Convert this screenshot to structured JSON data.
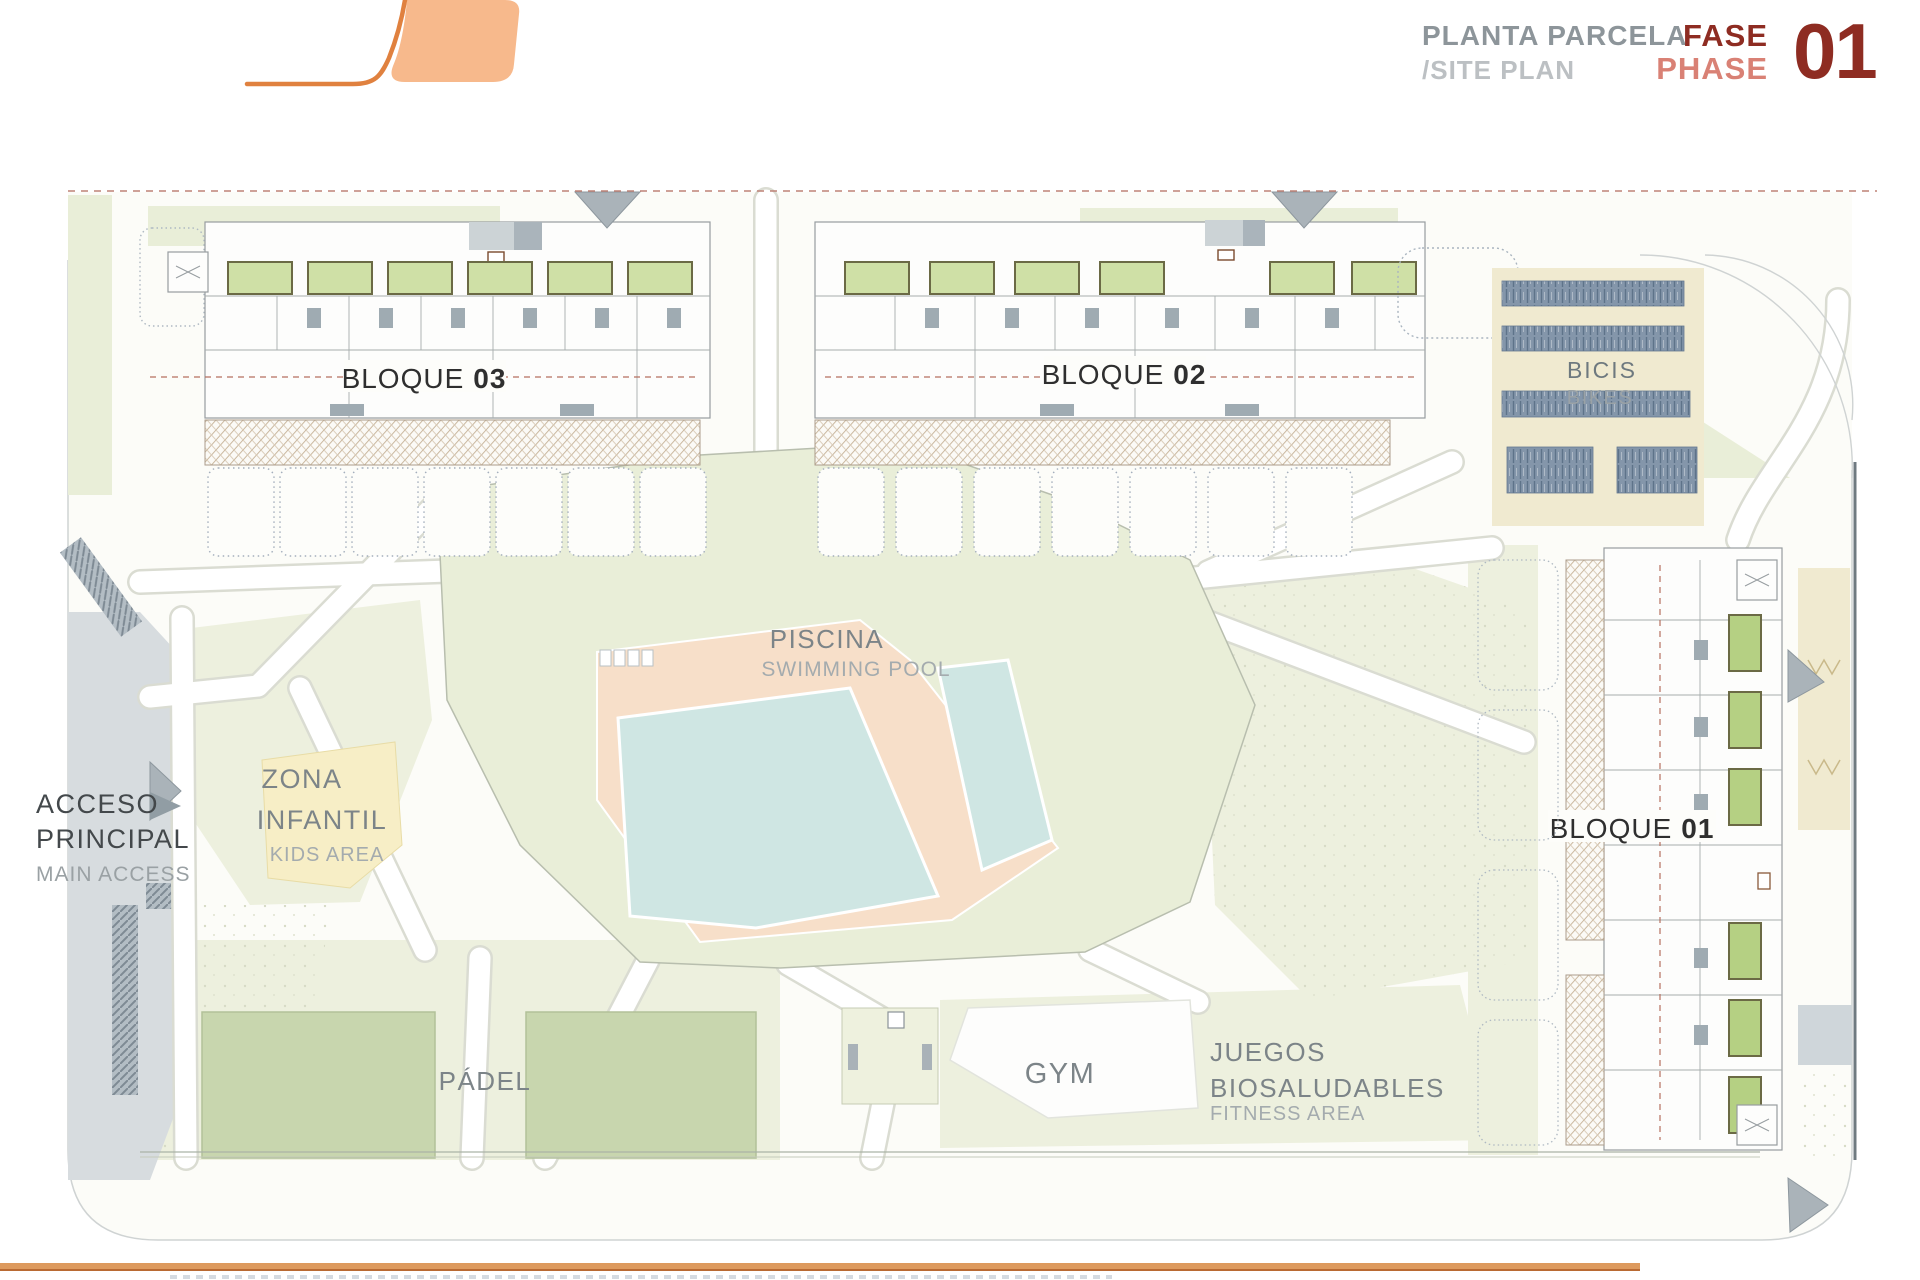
{
  "header": {
    "title_es": "PLANTA PARCELA",
    "title_en": "/SITE PLAN",
    "phase_label_es": "FASE",
    "phase_label_en": "PHASE",
    "phase_number": "01"
  },
  "site_plan": {
    "bloque03": {
      "prefix": "BLOQUE",
      "number": "03"
    },
    "bloque02": {
      "prefix": "BLOQUE",
      "number": "02"
    },
    "bloque01": {
      "prefix": "BLOQUE",
      "number": "01"
    },
    "bicis": {
      "es": "BICIS",
      "en": "BIKES"
    },
    "piscina": {
      "es": "PISCINA",
      "en": "SWIMMING POOL"
    },
    "zona_infantil": {
      "es1": "ZONA",
      "es2": "INFANTIL",
      "en": "KIDS AREA"
    },
    "acceso": {
      "es1": "ACCESO",
      "es2": "PRINCIPAL",
      "en": "MAIN ACCESS"
    },
    "padel": {
      "es": "PÁDEL"
    },
    "gym": {
      "es": "GYM"
    },
    "juegos": {
      "es1": "JUEGOS",
      "es2": "BIOSALUDABLES",
      "en": "FITNESS AREA"
    }
  },
  "colors": {
    "accent_orange": "#e0813f",
    "logo_fill": "#f7b98c",
    "dark_red": "#8e2c22",
    "salmon_red": "#d98175",
    "title_gray": "#8d959a",
    "subtitle_gray": "#bcc0c3",
    "lawn": "#e9eed8",
    "water": "#cfe6e3",
    "deck": "#f7dfc9",
    "court": "#c8d6ae",
    "terrace": "#cfe0a6",
    "kids_yellow": "#f7eec6",
    "road": "#d7dcdf",
    "cream": "#f0ead0",
    "bottom_rule": "#dd9a5e",
    "dash_line": "#bd8276"
  }
}
